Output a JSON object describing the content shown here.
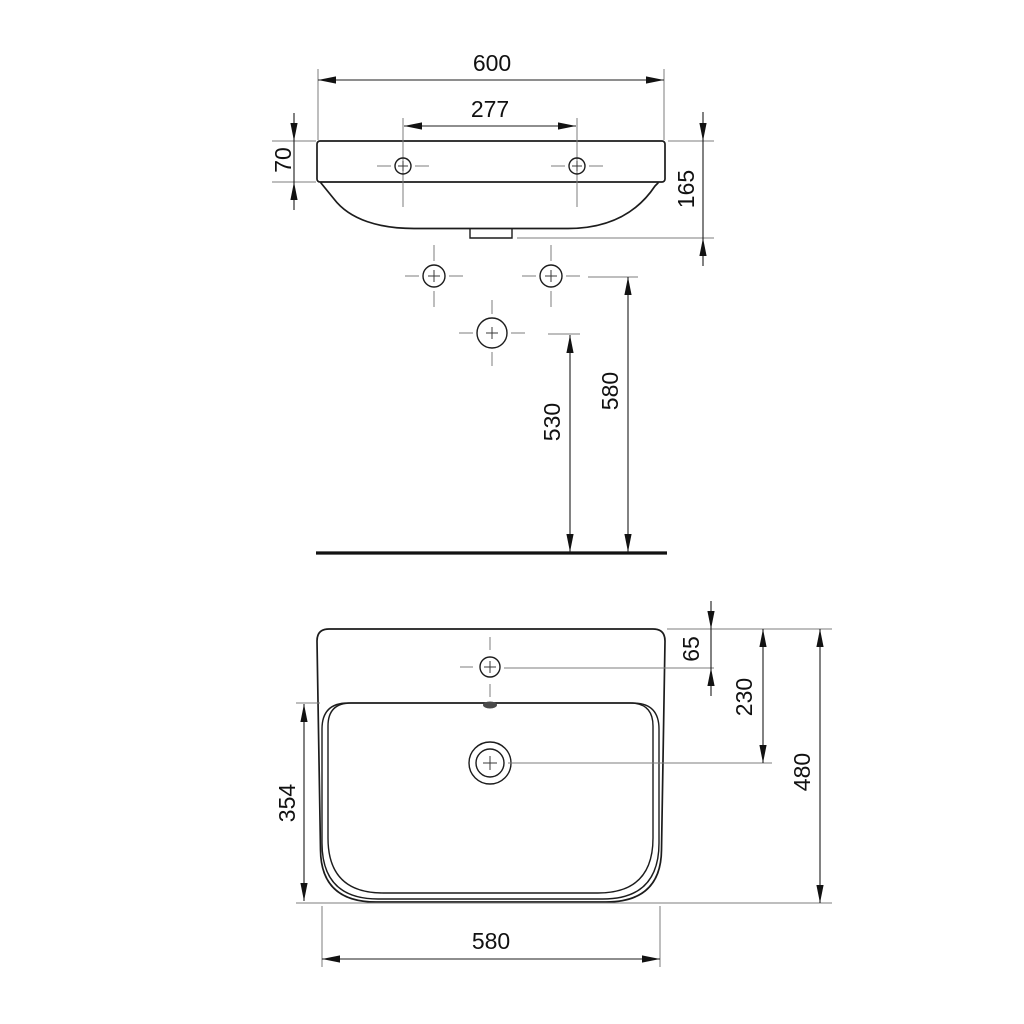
{
  "drawing": {
    "type": "washbasin-dimensional-drawing",
    "colors": {
      "background": "#ffffff",
      "line": "#1c1c1c",
      "centerline": "#7e7e7e"
    },
    "front_view": {
      "overall_width": "600",
      "faucet_hole_spacing": "277",
      "rim_height": "70",
      "basin_height": "165",
      "drain_height_from_floor": "530",
      "fixing_holes_height_from_floor": "580"
    },
    "plan_view": {
      "faucet_hole_offset": "65",
      "drain_center_offset": "230",
      "overall_depth": "480",
      "inner_bowl_depth": "354",
      "bottom_width": "580"
    }
  }
}
